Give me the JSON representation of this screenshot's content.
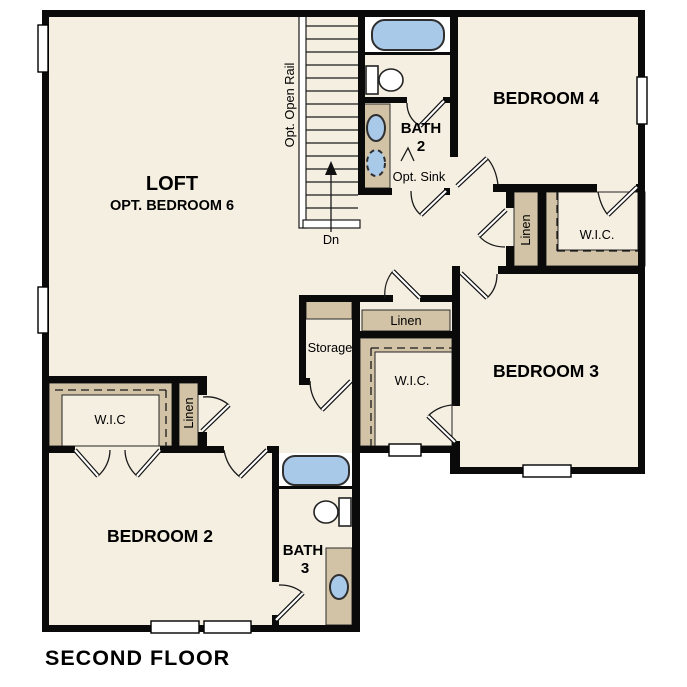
{
  "floor_plan_title": "SECOND FLOOR",
  "palette": {
    "paper": "#ffffff",
    "floor": "#f5efe2",
    "closet": "#d2c3a6",
    "wall": "#0a0a0a",
    "fixture_blue": "#a9c9e9"
  },
  "rooms": {
    "loft": {
      "name": "LOFT",
      "subtitle": "OPT. BEDROOM 6"
    },
    "bedroom_4": {
      "name": "BEDROOM 4"
    },
    "bedroom_3": {
      "name": "BEDROOM 3"
    },
    "bedroom_2": {
      "name": "BEDROOM 2"
    },
    "bath_2": {
      "name_line_1": "BATH",
      "name_line_2": "2",
      "opt_sink_label": "Opt. Sink"
    },
    "bath_3": {
      "name_line_1": "BATH",
      "name_line_2": "3"
    },
    "storage": {
      "name": "Storage"
    }
  },
  "closets": {
    "wic_bedroom_4": {
      "label": "W.I.C."
    },
    "wic_bedroom_3": {
      "label": "W.I.C."
    },
    "wic_bedroom_2": {
      "label": "W.I.C"
    },
    "linen_upper_hall": {
      "label": "Linen"
    },
    "linen_hall": {
      "label": "Linen"
    },
    "linen_bedroom_2": {
      "label": "Linen"
    }
  },
  "stairs": {
    "down_label": "Dn",
    "rail_label": "Opt. Open Rail"
  }
}
